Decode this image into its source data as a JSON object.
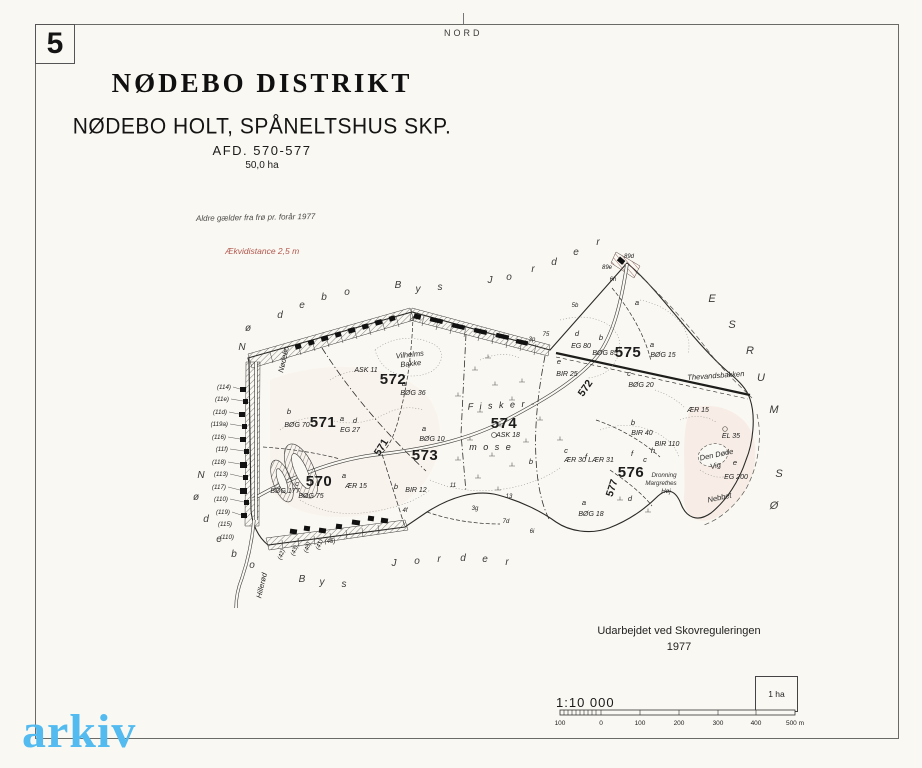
{
  "page": {
    "sheet_number": "5",
    "north_label": "NORD"
  },
  "title_block": {
    "district": "NØDEBO DISTRIKT",
    "subtitle": "NØDEBO HOLT,  SPÅNELTSHUS SKP.",
    "afd": "AFD.  570-577",
    "area": "50,0 ha"
  },
  "notes": {
    "age_note": "Aldre gælder fra frø pr. forår 1977",
    "equidistance": "Ækvidistance 2,5 m",
    "equidistance_color": "#b0574e"
  },
  "credits": {
    "line1": "Udarbejdet ved Skovreguleringen",
    "line2": "1977"
  },
  "scale": {
    "ratio": "1:10 000",
    "tick_labels": [
      "100",
      "0",
      "100",
      "200",
      "300",
      "400",
      "500 m"
    ],
    "area_box_label": "1 ha"
  },
  "watermark": {
    "text": "arkiv",
    "color": "#53bbf0"
  },
  "map": {
    "labels": [
      {
        "t": "570",
        "x": 319,
        "y": 486,
        "c": "comp",
        "n": "compartment-570"
      },
      {
        "t": "571",
        "x": 323,
        "y": 427,
        "c": "comp",
        "n": "compartment-571"
      },
      {
        "t": "572",
        "x": 393,
        "y": 384,
        "c": "comp",
        "n": "compartment-572"
      },
      {
        "t": "573",
        "x": 425,
        "y": 460,
        "c": "comp",
        "n": "compartment-573"
      },
      {
        "t": "574",
        "x": 504,
        "y": 428,
        "c": "comp",
        "n": "compartment-574"
      },
      {
        "t": "575",
        "x": 628,
        "y": 357,
        "c": "comp",
        "n": "compartment-575"
      },
      {
        "t": "576",
        "x": 631,
        "y": 477,
        "c": "comp",
        "n": "compartment-576"
      },
      {
        "t": "572",
        "x": 588,
        "y": 390,
        "c": "comp-rot",
        "r": -55,
        "n": "compartment-572-road"
      },
      {
        "t": "577",
        "x": 615,
        "y": 489,
        "c": "comp-rot",
        "r": -72,
        "n": "compartment-577-road"
      },
      {
        "t": "571",
        "x": 384,
        "y": 449,
        "c": "comp-rot",
        "r": -58,
        "n": "compartment-571-road"
      },
      {
        "t": "b",
        "x": 289,
        "y": 414,
        "c": "letter"
      },
      {
        "t": "BØG 70",
        "x": 297,
        "y": 427,
        "c": "stand"
      },
      {
        "t": "ASK 11",
        "x": 366,
        "y": 372,
        "c": "stand"
      },
      {
        "t": "a",
        "x": 404,
        "y": 386,
        "c": "letter"
      },
      {
        "t": "BØG 36",
        "x": 413,
        "y": 395,
        "c": "stand"
      },
      {
        "t": "a",
        "x": 342,
        "y": 421,
        "c": "letter"
      },
      {
        "t": "d",
        "x": 355,
        "y": 423,
        "c": "letter"
      },
      {
        "t": "EG 27",
        "x": 350,
        "y": 432,
        "c": "stand"
      },
      {
        "t": "a",
        "x": 424,
        "y": 431,
        "c": "letter"
      },
      {
        "t": "BØG 10",
        "x": 432,
        "y": 441,
        "c": "stand"
      },
      {
        "t": "b",
        "x": 396,
        "y": 489,
        "c": "letter"
      },
      {
        "t": "BIR 12",
        "x": 416,
        "y": 492,
        "c": "stand"
      },
      {
        "t": "c",
        "x": 297,
        "y": 486,
        "c": "letter"
      },
      {
        "t": "BØG 177",
        "x": 285,
        "y": 493,
        "c": "stand"
      },
      {
        "t": "BØG 75",
        "x": 311,
        "y": 498,
        "c": "stand"
      },
      {
        "t": "a",
        "x": 344,
        "y": 478,
        "c": "letter"
      },
      {
        "t": "ÆR 15",
        "x": 356,
        "y": 488,
        "c": "stand"
      },
      {
        "t": "ASK 18",
        "x": 508,
        "y": 437,
        "c": "stand"
      },
      {
        "t": "b",
        "x": 531,
        "y": 464,
        "c": "letter"
      },
      {
        "t": "c",
        "x": 566,
        "y": 453,
        "c": "letter"
      },
      {
        "t": "ÆR 30",
        "x": 575,
        "y": 462,
        "c": "stand"
      },
      {
        "t": "f",
        "x": 586,
        "y": 459,
        "c": "letter"
      },
      {
        "t": "LÆR 31",
        "x": 601,
        "y": 462,
        "c": "stand"
      },
      {
        "t": "a",
        "x": 584,
        "y": 505,
        "c": "letter"
      },
      {
        "t": "BØG 18",
        "x": 591,
        "y": 516,
        "c": "stand"
      },
      {
        "t": "e",
        "x": 559,
        "y": 364,
        "c": "letter"
      },
      {
        "t": "BIR 25",
        "x": 567,
        "y": 376,
        "c": "stand"
      },
      {
        "t": "d",
        "x": 577,
        "y": 336,
        "c": "letter"
      },
      {
        "t": "EG 80",
        "x": 581,
        "y": 348,
        "c": "stand"
      },
      {
        "t": "b",
        "x": 601,
        "y": 340,
        "c": "letter"
      },
      {
        "t": "BØG 85",
        "x": 605,
        "y": 355,
        "c": "stand"
      },
      {
        "t": "a",
        "x": 637,
        "y": 305,
        "c": "letter"
      },
      {
        "t": "a",
        "x": 652,
        "y": 347,
        "c": "letter"
      },
      {
        "t": "BØG 15",
        "x": 663,
        "y": 357,
        "c": "stand"
      },
      {
        "t": "c",
        "x": 629,
        "y": 376,
        "c": "letter"
      },
      {
        "t": "BØG 20",
        "x": 641,
        "y": 387,
        "c": "stand"
      },
      {
        "t": "ÆR 15",
        "x": 698,
        "y": 412,
        "c": "stand"
      },
      {
        "t": "b",
        "x": 633,
        "y": 425,
        "c": "letter"
      },
      {
        "t": "BIR 40",
        "x": 642,
        "y": 435,
        "c": "stand"
      },
      {
        "t": "h",
        "x": 653,
        "y": 453,
        "c": "letter"
      },
      {
        "t": "BIR 110",
        "x": 667,
        "y": 446,
        "c": "stand"
      },
      {
        "t": "f",
        "x": 632,
        "y": 456,
        "c": "letter"
      },
      {
        "t": "c",
        "x": 645,
        "y": 462,
        "c": "letter"
      },
      {
        "t": "d",
        "x": 630,
        "y": 501,
        "c": "letter"
      },
      {
        "t": "EL 35",
        "x": 731,
        "y": 438,
        "c": "stand"
      },
      {
        "t": "e",
        "x": 735,
        "y": 465,
        "c": "letter"
      },
      {
        "t": "EG 200",
        "x": 736,
        "y": 479,
        "c": "stand"
      },
      {
        "t": "89d",
        "x": 629,
        "y": 258,
        "c": "tiny"
      },
      {
        "t": "89e",
        "x": 607,
        "y": 269,
        "c": "tiny"
      },
      {
        "t": "6h",
        "x": 613,
        "y": 281,
        "c": "tiny"
      },
      {
        "t": "5b",
        "x": 575,
        "y": 307,
        "c": "tiny"
      },
      {
        "t": "3p",
        "x": 532,
        "y": 341,
        "c": "tiny"
      },
      {
        "t": "75",
        "x": 546,
        "y": 336,
        "c": "tiny"
      },
      {
        "t": "4f",
        "x": 405,
        "y": 512,
        "c": "tiny"
      },
      {
        "t": "3g",
        "x": 475,
        "y": 510,
        "c": "tiny"
      },
      {
        "t": "7d",
        "x": 506,
        "y": 523,
        "c": "tiny"
      },
      {
        "t": "6i",
        "x": 532,
        "y": 533,
        "c": "tiny"
      },
      {
        "t": "11",
        "x": 453,
        "y": 487,
        "c": "tiny"
      },
      {
        "t": "13",
        "x": 509,
        "y": 498,
        "c": "tiny"
      },
      {
        "t": "(45)",
        "x": 330,
        "y": 543,
        "c": "tiny"
      },
      {
        "t": "(42)",
        "x": 283,
        "y": 555,
        "c": "tiny",
        "r": -70
      },
      {
        "t": "(43)",
        "x": 296,
        "y": 551,
        "c": "tiny",
        "r": -70
      },
      {
        "t": "(48)",
        "x": 309,
        "y": 548,
        "c": "tiny",
        "r": -70
      },
      {
        "t": "(41)",
        "x": 321,
        "y": 545,
        "c": "tiny",
        "r": -70
      },
      {
        "t": "(114)",
        "x": 231,
        "y": 389,
        "c": "cad",
        "n": "cadastral-number"
      },
      {
        "t": "(11e)",
        "x": 229,
        "y": 401,
        "c": "cad",
        "n": "cadastral-number"
      },
      {
        "t": "(11d)",
        "x": 227,
        "y": 414,
        "c": "cad",
        "n": "cadastral-number"
      },
      {
        "t": "(119a)",
        "x": 228,
        "y": 426,
        "c": "cad",
        "n": "cadastral-number"
      },
      {
        "t": "(116)",
        "x": 226,
        "y": 439,
        "c": "cad",
        "n": "cadastral-number"
      },
      {
        "t": "(11f)",
        "x": 228,
        "y": 451,
        "c": "cad",
        "n": "cadastral-number"
      },
      {
        "t": "(118)",
        "x": 226,
        "y": 464,
        "c": "cad",
        "n": "cadastral-number"
      },
      {
        "t": "(113)",
        "x": 228,
        "y": 476,
        "c": "cad",
        "n": "cadastral-number"
      },
      {
        "t": "(117)",
        "x": 226,
        "y": 489,
        "c": "cad",
        "n": "cadastral-number"
      },
      {
        "t": "(110)",
        "x": 228,
        "y": 501,
        "c": "cad",
        "n": "cadastral-number"
      },
      {
        "t": "(119)",
        "x": 230,
        "y": 514,
        "c": "cad",
        "n": "cadastral-number"
      },
      {
        "t": "(115)",
        "x": 232,
        "y": 526,
        "c": "cad",
        "n": "cadastral-number"
      },
      {
        "t": "(110)",
        "x": 234,
        "y": 539,
        "c": "cad",
        "n": "cadastral-number"
      },
      {
        "t": "Vilhelms",
        "x": 410,
        "y": 357,
        "c": "place",
        "r": -6,
        "n": "place-vilhelms-bakke"
      },
      {
        "t": "Bakke",
        "x": 411,
        "y": 366,
        "c": "place",
        "r": -6,
        "n": "place-vilhelms-bakke"
      },
      {
        "t": "F i s k e r -",
        "x": 502,
        "y": 408,
        "c": "place-lg",
        "r": -3,
        "n": "place-fiskermose"
      },
      {
        "t": "m o s e",
        "x": 491,
        "y": 450,
        "c": "place-lg",
        "n": "place-fiskermose"
      },
      {
        "t": "Thevandsbakken",
        "x": 716,
        "y": 378,
        "c": "place",
        "r": -4,
        "n": "place-thevandsbakken"
      },
      {
        "t": "Den Døde",
        "x": 717,
        "y": 457,
        "c": "place",
        "r": -12,
        "n": "place-den-doede-vig"
      },
      {
        "t": "Vig",
        "x": 716,
        "y": 468,
        "c": "place",
        "r": -12,
        "n": "place-den-doede-vig"
      },
      {
        "t": "Dronning",
        "x": 664,
        "y": 477,
        "c": "place-sm",
        "n": "place-dronning-margrethes-hoej"
      },
      {
        "t": "Margrethes",
        "x": 661,
        "y": 485,
        "c": "place-sm",
        "n": "place-dronning-margrethes-hoej"
      },
      {
        "t": "Høj",
        "x": 666,
        "y": 493,
        "c": "place-sm",
        "n": "place-dronning-margrethes-hoej"
      },
      {
        "t": "Nebbet",
        "x": 720,
        "y": 500,
        "c": "place",
        "r": -12,
        "n": "place-nebbet"
      },
      {
        "t": "Hillerød",
        "x": 264,
        "y": 586,
        "c": "place",
        "r": -77,
        "n": "road-label-hilleroed"
      },
      {
        "t": "Nødebo",
        "x": 286,
        "y": 360,
        "c": "place",
        "r": -77,
        "n": "road-label-noedebo"
      },
      {
        "t": "N",
        "x": 242,
        "y": 350,
        "c": "spread",
        "n": "boundary-text-noedebo-bys-jorder"
      },
      {
        "t": "ø",
        "x": 248,
        "y": 331,
        "c": "spread",
        "n": "boundary-text-noedebo-bys-jorder"
      },
      {
        "t": "d",
        "x": 280,
        "y": 318,
        "c": "spread",
        "n": "boundary-text-noedebo-bys-jorder"
      },
      {
        "t": "e",
        "x": 302,
        "y": 308,
        "c": "spread",
        "n": "boundary-text-noedebo-bys-jorder"
      },
      {
        "t": "b",
        "x": 324,
        "y": 300,
        "c": "spread",
        "n": "boundary-text-noedebo-bys-jorder"
      },
      {
        "t": "o",
        "x": 347,
        "y": 295,
        "c": "spread",
        "n": "boundary-text-noedebo-bys-jorder"
      },
      {
        "t": "B",
        "x": 398,
        "y": 288,
        "c": "spread",
        "n": "boundary-text-noedebo-bys-jorder"
      },
      {
        "t": "y",
        "x": 418,
        "y": 292,
        "c": "spread",
        "n": "boundary-text-noedebo-bys-jorder"
      },
      {
        "t": "s",
        "x": 440,
        "y": 290,
        "c": "spread",
        "n": "boundary-text-noedebo-bys-jorder"
      },
      {
        "t": "J",
        "x": 490,
        "y": 283,
        "c": "spread",
        "n": "boundary-text-noedebo-bys-jorder"
      },
      {
        "t": "o",
        "x": 509,
        "y": 280,
        "c": "spread",
        "n": "boundary-text-noedebo-bys-jorder"
      },
      {
        "t": "r",
        "x": 533,
        "y": 272,
        "c": "spread",
        "n": "boundary-text-noedebo-bys-jorder"
      },
      {
        "t": "d",
        "x": 554,
        "y": 265,
        "c": "spread",
        "n": "boundary-text-noedebo-bys-jorder"
      },
      {
        "t": "e",
        "x": 576,
        "y": 255,
        "c": "spread",
        "n": "boundary-text-noedebo-bys-jorder"
      },
      {
        "t": "r",
        "x": 598,
        "y": 245,
        "c": "spread",
        "n": "boundary-text-noedebo-bys-jorder"
      },
      {
        "t": "N",
        "x": 201,
        "y": 478,
        "c": "spread",
        "n": "boundary-text-bys-jorder-south"
      },
      {
        "t": "ø",
        "x": 196,
        "y": 500,
        "c": "spread",
        "n": "boundary-text-bys-jorder-south"
      },
      {
        "t": "d",
        "x": 206,
        "y": 522,
        "c": "spread",
        "n": "boundary-text-bys-jorder-south"
      },
      {
        "t": "e",
        "x": 219,
        "y": 542,
        "c": "spread",
        "n": "boundary-text-bys-jorder-south"
      },
      {
        "t": "b",
        "x": 234,
        "y": 557,
        "c": "spread",
        "n": "boundary-text-bys-jorder-south"
      },
      {
        "t": "o",
        "x": 252,
        "y": 568,
        "c": "spread",
        "n": "boundary-text-bys-jorder-south"
      },
      {
        "t": "B",
        "x": 302,
        "y": 582,
        "c": "spread",
        "n": "boundary-text-bys-jorder-south"
      },
      {
        "t": "y",
        "x": 322,
        "y": 585,
        "c": "spread",
        "n": "boundary-text-bys-jorder-south"
      },
      {
        "t": "s",
        "x": 344,
        "y": 587,
        "c": "spread",
        "n": "boundary-text-bys-jorder-south"
      },
      {
        "t": "J",
        "x": 394,
        "y": 566,
        "c": "spread",
        "n": "boundary-text-bys-jorder-south"
      },
      {
        "t": "o",
        "x": 417,
        "y": 564,
        "c": "spread",
        "n": "boundary-text-bys-jorder-south"
      },
      {
        "t": "r",
        "x": 439,
        "y": 562,
        "c": "spread",
        "n": "boundary-text-bys-jorder-south"
      },
      {
        "t": "d",
        "x": 463,
        "y": 561,
        "c": "spread",
        "n": "boundary-text-bys-jorder-south"
      },
      {
        "t": "e",
        "x": 485,
        "y": 562,
        "c": "spread",
        "n": "boundary-text-bys-jorder-south"
      },
      {
        "t": "r",
        "x": 507,
        "y": 565,
        "c": "spread",
        "n": "boundary-text-bys-jorder-south"
      },
      {
        "t": "E",
        "x": 712,
        "y": 302,
        "c": "shore",
        "n": "lake-text-esrum-soe"
      },
      {
        "t": "S",
        "x": 732,
        "y": 328,
        "c": "shore",
        "n": "lake-text-esrum-soe"
      },
      {
        "t": "R",
        "x": 750,
        "y": 354,
        "c": "shore",
        "n": "lake-text-esrum-soe"
      },
      {
        "t": "U",
        "x": 761,
        "y": 381,
        "c": "shore",
        "n": "lake-text-esrum-soe"
      },
      {
        "t": "M",
        "x": 774,
        "y": 413,
        "c": "shore",
        "n": "lake-text-esrum-soe"
      },
      {
        "t": "S",
        "x": 779,
        "y": 477,
        "c": "shore",
        "n": "lake-text-esrum-soe"
      },
      {
        "t": "Ø",
        "x": 774,
        "y": 509,
        "c": "shore",
        "n": "lake-text-esrum-soe"
      }
    ]
  }
}
